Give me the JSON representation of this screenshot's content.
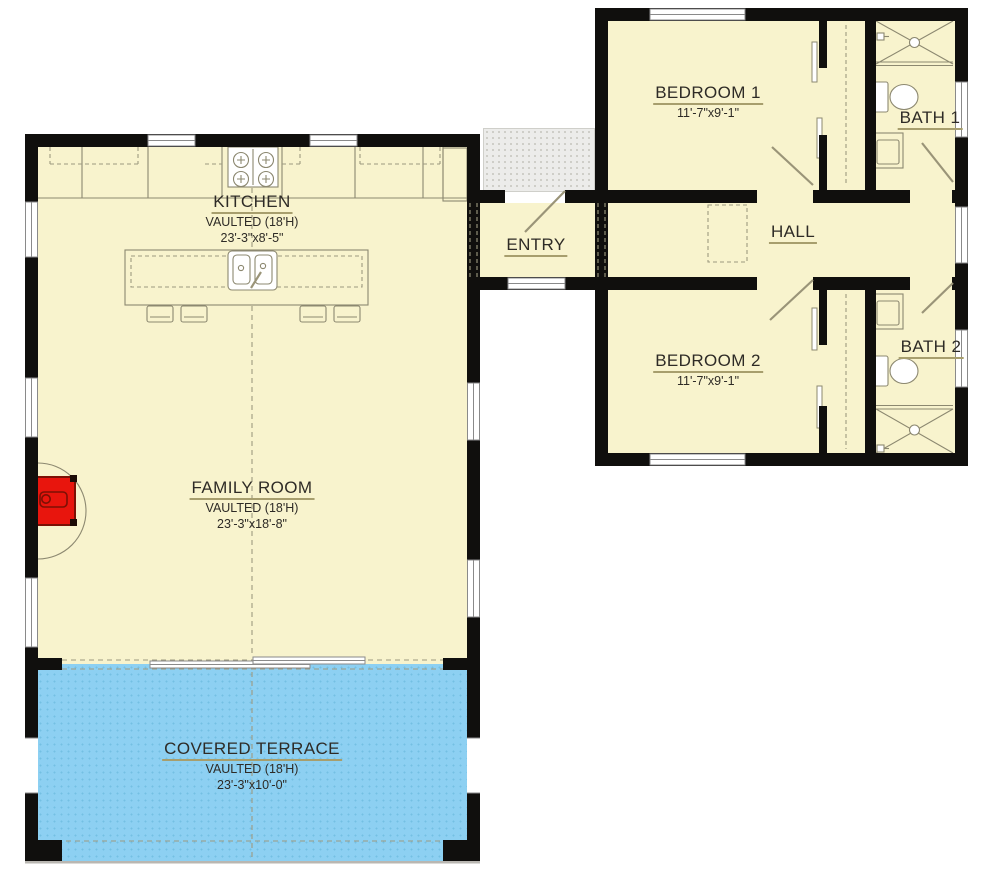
{
  "colors": {
    "wall": "#100f0d",
    "room_fill": "#f8f3cd",
    "terrace_fill": "#8dd0f2",
    "terrace_dot": "#74bfe3",
    "stoop_fill": "#ececе8",
    "stoop_fill_fix": "#ececе8",
    "stoop_dot": "#c7c6c0",
    "line": "#8c8870",
    "dash": "#9d9a80",
    "leaf": "#9a9478",
    "window_frame": "#8a8a8a",
    "text": "#2e2b26",
    "underline": "#a79e6d",
    "stove_red": "#e8150d",
    "stove_dark": "#7c1004",
    "ground_line": "#b9b7b2"
  },
  "rooms": {
    "kitchen": {
      "name": "KITCHEN",
      "vaulted": "VAULTED (18'H)",
      "dims": "23'-3\"x8'-5\""
    },
    "family_room": {
      "name": "FAMILY ROOM",
      "vaulted": "VAULTED (18'H)",
      "dims": "23'-3\"x18'-8\""
    },
    "covered_terrace": {
      "name": "COVERED TERRACE",
      "vaulted": "VAULTED (18'H)",
      "dims": "23'-3\"x10'-0\""
    },
    "bedroom_1": {
      "name": "BEDROOM 1",
      "dims": "11'-7\"x9'-1\""
    },
    "bedroom_2": {
      "name": "BEDROOM 2",
      "dims": "11'-7\"x9'-1\""
    },
    "bath_1": {
      "name": "BATH 1"
    },
    "bath_2": {
      "name": "BATH 2"
    },
    "hall": {
      "name": "HALL"
    },
    "entry": {
      "name": "ENTRY"
    }
  }
}
